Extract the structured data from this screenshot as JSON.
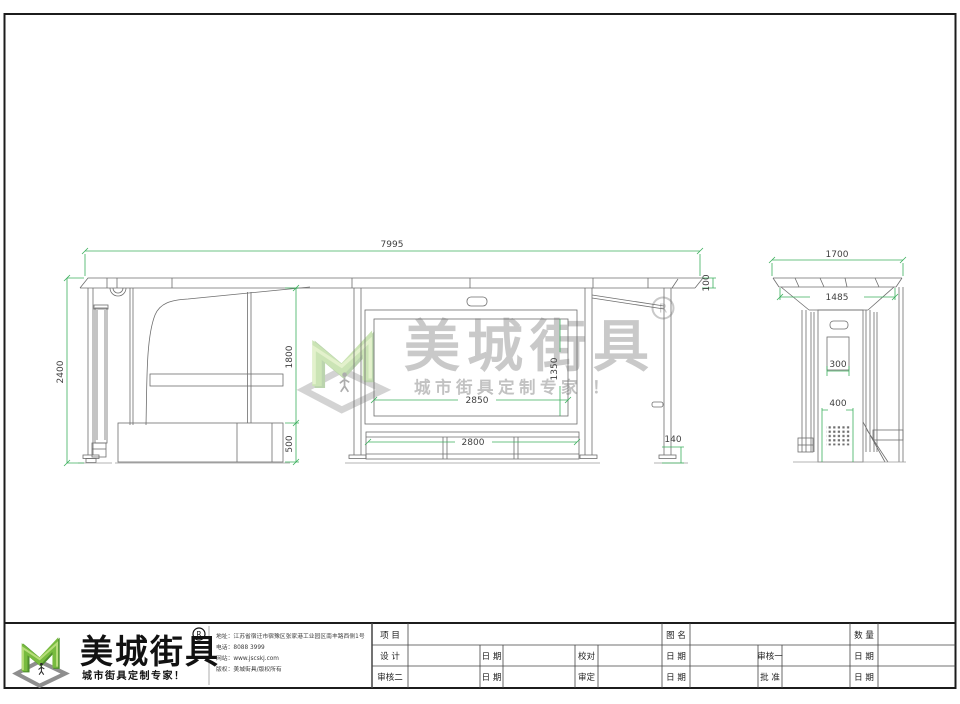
{
  "drawing": {
    "dims": {
      "front_total_width": "7995",
      "front_total_height": "2400",
      "front_clear_height": "1800",
      "front_base_height": "500",
      "panel_width": "2850",
      "panel_height": "1350",
      "bench_width": "2800",
      "post_base": "140",
      "roof_thickness": "100",
      "side_roof_width": "1700",
      "side_body_width": "1485",
      "side_panel_width": "300",
      "side_grille_width": "400"
    }
  },
  "watermark": {
    "brand": "美城街具",
    "registered": "R",
    "tagline": "城市街具定制专家 ！"
  },
  "title_block": {
    "brand": "美城街具",
    "registered": "R",
    "brand_tagline": "城市街具定制专家！",
    "company_lines": [
      "地址：江苏省宿迁市宿豫区张家港工业园区南丰路西侧1号",
      "电话：8088 3999",
      "网站：www.jscskj.com",
      "版权：美城街具/版权所有"
    ],
    "fields": {
      "project": "项 目",
      "drawing_name": "图 名",
      "quantity": "数 量",
      "design": "设 计",
      "date": "日 期",
      "proofread": "校对",
      "reviewer1": "审核一",
      "reviewer2": "审核二",
      "approve": "审定",
      "ratify": "批 准"
    }
  },
  "colors": {
    "dimension_green": "#3cb05e",
    "line_gray": "#6e6e6e",
    "logo_green": "#78bb3f"
  }
}
